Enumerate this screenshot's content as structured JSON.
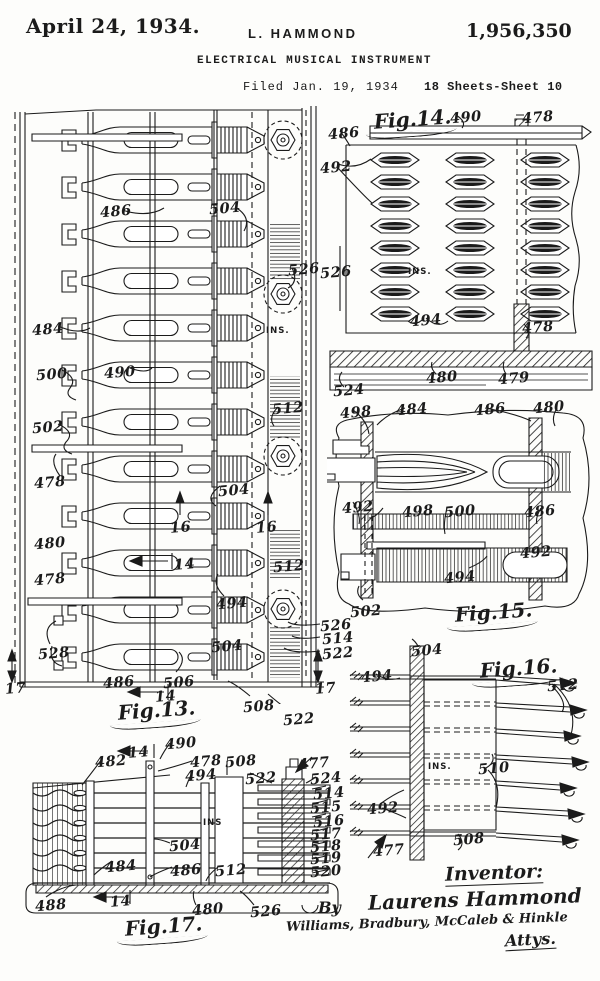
{
  "header": {
    "date": "April 24, 1934.",
    "inventor": "L. HAMMOND",
    "patent_number": "1,956,350",
    "title": "ELECTRICAL MUSICAL INSTRUMENT",
    "filed": "Filed Jan. 19, 1934",
    "sheet": "18 Sheets-Sheet 10"
  },
  "figures": {
    "fig13": {
      "caption": "Fig.13.",
      "refs": [
        "486",
        "504",
        "526",
        "484",
        "500",
        "490",
        "502",
        "478",
        "512",
        "INS.",
        "504",
        "16",
        "16",
        "14",
        "480",
        "478",
        "494",
        "512",
        "528",
        "504",
        "486",
        "506",
        "508",
        "522",
        "526",
        "514",
        "522",
        "17",
        "17",
        "14"
      ]
    },
    "fig14": {
      "caption": "Fig.14.",
      "refs": [
        "490",
        "478",
        "486",
        "492",
        "526",
        "INS.",
        "494",
        "478",
        "480",
        "479",
        "524"
      ]
    },
    "fig15": {
      "caption": "Fig.15.",
      "refs": [
        "498",
        "484",
        "486",
        "480",
        "492",
        "498",
        "500",
        "486",
        "492",
        "494",
        "502"
      ]
    },
    "fig16": {
      "caption": "Fig.16.",
      "refs": [
        "504",
        "494",
        "512",
        "510",
        "INS.",
        "492",
        "508",
        "477"
      ]
    },
    "fig17": {
      "caption": "Fig.17.",
      "refs": [
        "482",
        "14",
        "490",
        "478",
        "508",
        "494",
        "522",
        "477",
        "524",
        "514",
        "515",
        "516",
        "517",
        "518",
        "519",
        "520",
        "504",
        "484",
        "486",
        "512",
        "488",
        "14",
        "480",
        "526",
        "INS"
      ]
    }
  },
  "signature": {
    "inventor_label": "Inventor:",
    "inventor_name": "Laurens Hammond",
    "by": "By",
    "attorneys": "Williams, Bradbury, McCaleb & Hinkle",
    "attys": "Attys."
  }
}
